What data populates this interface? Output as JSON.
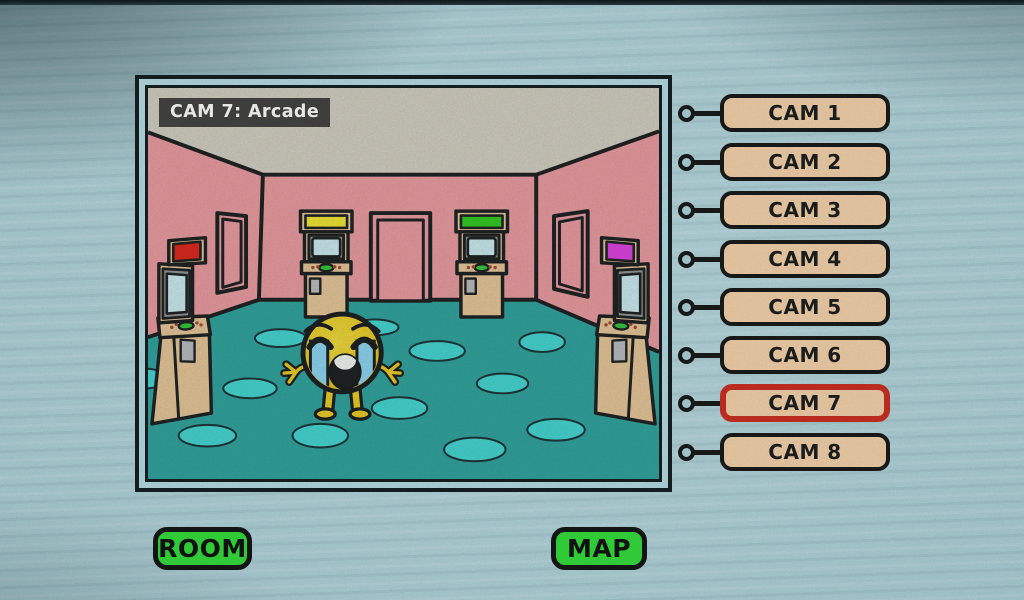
{
  "camera_view": {
    "title": "CAM 7: Arcade",
    "active_camera": "CAM 7",
    "room": "Arcade"
  },
  "scene": {
    "character": "crying emoji standing in arcade",
    "doorway_count": 3,
    "colors": {
      "ceiling": "#d7d0c1",
      "wall": "#f19a9e",
      "floor": "#2aa29b",
      "floor_spot": "#3fd8d3",
      "cabinet": "#ecc795",
      "bezel": "#8f9193",
      "screen": "#cfeef2",
      "slot": "#bcbdbf",
      "panel_button": "#2ec82e",
      "emoji": "#f1cd1c",
      "tears": "#8ed7f4",
      "outline": "#161616"
    },
    "cabinets": [
      {
        "position": "left-wall",
        "marquee_color": "#e01d10"
      },
      {
        "position": "back-wall-left",
        "marquee_color": "#f6e92a"
      },
      {
        "position": "back-wall-right",
        "marquee_color": "#2ccb17"
      },
      {
        "position": "right-wall",
        "marquee_color": "#e33ae3"
      }
    ]
  },
  "camera_buttons": {
    "fill": "#ecc9a2",
    "selected_border": "#c3291c",
    "items": [
      {
        "label": "CAM 1",
        "selected": false
      },
      {
        "label": "CAM 2",
        "selected": false
      },
      {
        "label": "CAM 3",
        "selected": false
      },
      {
        "label": "CAM 4",
        "selected": false
      },
      {
        "label": "CAM 5",
        "selected": false
      },
      {
        "label": "CAM 6",
        "selected": false
      },
      {
        "label": "CAM 7",
        "selected": true
      },
      {
        "label": "CAM 8",
        "selected": false
      }
    ]
  },
  "action_buttons": {
    "room": "ROOM",
    "map": "MAP",
    "fill": "#2fd435"
  },
  "background": {
    "paper": "#a7ccd3"
  }
}
